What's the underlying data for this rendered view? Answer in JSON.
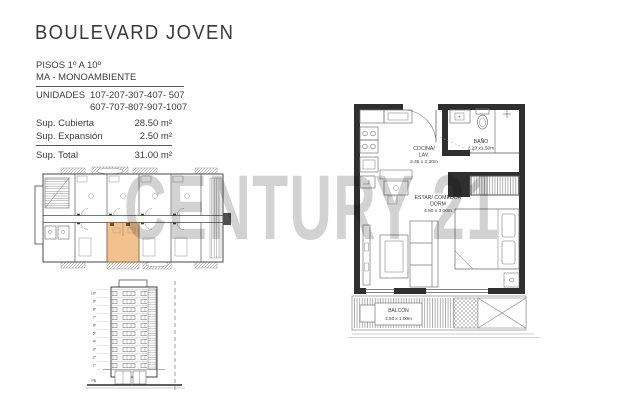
{
  "header": {
    "title": "BOULEVARD JOVEN"
  },
  "watermark": {
    "text": "CENTURY 21"
  },
  "info": {
    "pisos": "PISOS  1º A 10º",
    "tipo": "MA - MONOAMBIENTE",
    "unidades_label": "UNIDADES",
    "unidades_line1": "107-207-307-407- 507",
    "unidades_line2": "607-707-807-907-1007"
  },
  "areas": {
    "rows": [
      {
        "label": "Sup. Cubierta",
        "value": "28.50 m²"
      },
      {
        "label": "Sup. Expansión",
        "value": "2.50 m²"
      }
    ],
    "total_label": "Sup. Total",
    "total_value": "31.00 m²"
  },
  "unit_plan": {
    "kitchen_name": "COCINA/",
    "kitchen_name2": "LAV.",
    "kitchen_dim": "2.45 x 2.30m",
    "bath_name": "BAÑO",
    "bath_dim": "2.20 x1.50m",
    "living_name": "ESTAR/ COMEDOR",
    "living_name2": "DORM",
    "living_dim": "4.80 x 3.00m",
    "balcony_name": "BALCÓN",
    "balcony_dim": "2.50 x 1.00m"
  },
  "elevation": {
    "floors": [
      "10º",
      "9º",
      "8º",
      "7º",
      "6º",
      "5º",
      "4º",
      "3º",
      "2º",
      "1º"
    ],
    "ground": "PB"
  },
  "colors": {
    "highlight_unit": "#F2C28E",
    "watermark": "#D2D2D2",
    "wall": "#2F2F2F",
    "text": "#3B3B3B"
  }
}
